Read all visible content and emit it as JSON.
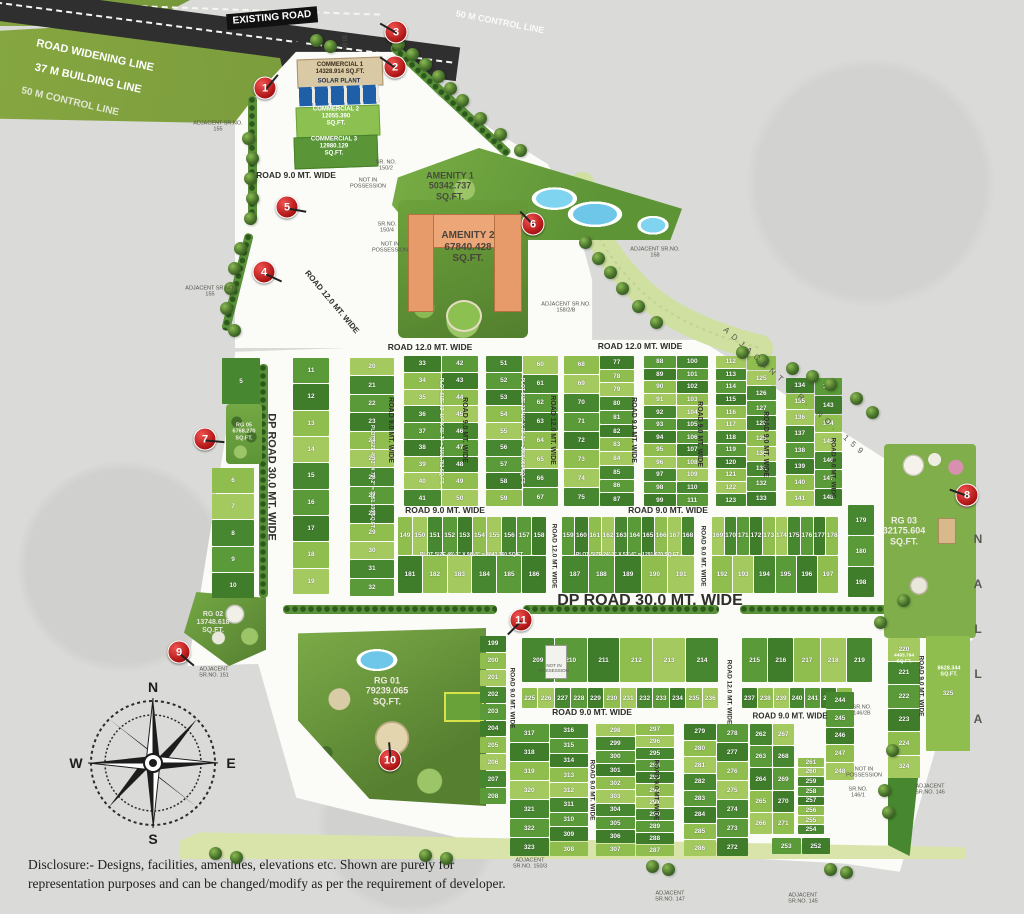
{
  "top": {
    "existing_road": "EXISTING ROAD",
    "widening": "ROAD WIDENING LINE",
    "building": "37 M BUILDING LINE",
    "control": "50 M CONTROL LINE",
    "control_right": "50 M CONTROL LINE",
    "dims": [
      "30.00",
      "37.00",
      "50.00"
    ]
  },
  "compass": {
    "north": "N",
    "east": "E",
    "south": "S",
    "west": "W"
  },
  "nalla": "NALLA",
  "disclosure": "Disclosure:- Designs, facilities, amenities, elevations etc. Shown are purely for representation purposes and can be changed/modify as per the requirement of developer.",
  "area_labels": [
    {
      "name": "commercial-1-label",
      "lines": [
        "COMMERCIAL 1",
        "14328.914 SQ.FT."
      ],
      "x": 340,
      "y": 69,
      "size": 6,
      "color": "#3a2d1c"
    },
    {
      "name": "solar-plant-label",
      "lines": [
        "SOLAR PLANT"
      ],
      "x": 339,
      "y": 82,
      "size": 6,
      "color": "#1d2b4d"
    },
    {
      "name": "commercial-2-label",
      "lines": [
        "COMMERCIAL 2",
        "12055.390",
        "SQ.FT."
      ],
      "x": 336,
      "y": 117,
      "size": 6,
      "color": "#ffffff"
    },
    {
      "name": "commercial-3-label",
      "lines": [
        "COMMERCIAL 3",
        "12980.129",
        "SQ.FT."
      ],
      "x": 334,
      "y": 147,
      "size": 6,
      "color": "#ffffff"
    },
    {
      "name": "amenity-1-label",
      "lines": [
        "AMENITY 1",
        "50342.737",
        "SQ.FT."
      ],
      "x": 450,
      "y": 186,
      "size": 9,
      "color": "#474b3e"
    },
    {
      "name": "amenity-2-label",
      "lines": [
        "AMENITY 2",
        "67840.428",
        "SQ.FT."
      ],
      "x": 468,
      "y": 247,
      "size": 10,
      "color": "#4a443c"
    },
    {
      "name": "rg-01-label",
      "lines": [
        "RG 01",
        "79239.065",
        "SQ.FT."
      ],
      "x": 387,
      "y": 691,
      "size": 9,
      "color": "#eceadf"
    },
    {
      "name": "rg-02-label",
      "lines": [
        "RG 02",
        "13748.618",
        "SQ.FT."
      ],
      "x": 213,
      "y": 623,
      "size": 7,
      "color": "#e4e6da"
    },
    {
      "name": "rg-03-label",
      "lines": [
        "RG 03",
        "32175.604",
        "SQ.FT."
      ],
      "x": 904,
      "y": 531,
      "size": 9,
      "color": "#efeee4"
    },
    {
      "name": "rg-05-label",
      "lines": [
        "RG 05",
        "6768.270",
        "SQ.FT."
      ],
      "x": 244,
      "y": 432,
      "size": 5.5,
      "color": "#f2f2ea"
    },
    {
      "name": "plot-325-area-label",
      "lines": [
        "8628.344",
        "SQ.FT."
      ],
      "x": 949,
      "y": 672,
      "size": 5.5,
      "color": "#ffffff"
    },
    {
      "name": "plot-220-area-label",
      "lines": [
        "4493.794",
        "SQ.FT."
      ],
      "x": 904,
      "y": 659,
      "size": 4.8,
      "color": "#ffffff"
    }
  ],
  "road_labels": [
    {
      "t": "ROAD 9.0 MT. WIDE",
      "x": 296,
      "y": 176,
      "rot": 0,
      "size": 8.5
    },
    {
      "t": "ROAD 12.0 MT. WIDE",
      "x": 332,
      "y": 302,
      "rot": 50,
      "size": 8
    },
    {
      "t": "ROAD 12.0 MT. WIDE",
      "x": 430,
      "y": 348,
      "rot": 0,
      "size": 8.5
    },
    {
      "t": "ROAD 12.0 MT. WIDE",
      "x": 640,
      "y": 347,
      "rot": 0,
      "size": 8.5
    },
    {
      "t": "ROAD 9.0 MT. WIDE",
      "x": 390,
      "y": 430,
      "rot": 90,
      "size": 7
    },
    {
      "t": "ROAD 9.0 MT. WIDE",
      "x": 464,
      "y": 430,
      "rot": 90,
      "size": 7
    },
    {
      "t": "ROAD 12.0 MT. WIDE",
      "x": 552,
      "y": 430,
      "rot": 90,
      "size": 7
    },
    {
      "t": "ROAD 9.0 MT. WIDE",
      "x": 633,
      "y": 430,
      "rot": 90,
      "size": 7
    },
    {
      "t": "ROAD 9.0 MT. WIDE",
      "x": 699,
      "y": 434,
      "rot": 90,
      "size": 7
    },
    {
      "t": "ROAD 9.0 MT. WIDE",
      "x": 765,
      "y": 444,
      "rot": 90,
      "size": 7
    },
    {
      "t": "ROAD 9.0 MT. WIDE",
      "x": 833,
      "y": 468,
      "rot": 90,
      "size": 6.5
    },
    {
      "t": "DP ROAD 30.0 MT. WIDE",
      "x": 271,
      "y": 477,
      "rot": 90,
      "size": 11
    },
    {
      "t": "ROAD 9.0 MT. WIDE",
      "x": 445,
      "y": 511,
      "rot": 0,
      "size": 8.5
    },
    {
      "t": "ROAD 9.0 MT. WIDE",
      "x": 668,
      "y": 511,
      "rot": 0,
      "size": 8.5
    },
    {
      "t": "ROAD 12.0 MT. WIDE",
      "x": 554,
      "y": 556,
      "rot": 90,
      "size": 6.5
    },
    {
      "t": "ROAD 9.0 MT. WIDE",
      "x": 703,
      "y": 556,
      "rot": 90,
      "size": 6.5
    },
    {
      "t": "DP ROAD 30.0 MT. WIDE",
      "x": 650,
      "y": 601,
      "rot": 0,
      "size": 16
    },
    {
      "t": "ROAD 9.0 MT. WIDE",
      "x": 592,
      "y": 713,
      "rot": 0,
      "size": 8.5
    },
    {
      "t": "ROAD 9.0 MT. WIDE",
      "x": 790,
      "y": 716,
      "rot": 0,
      "size": 8
    },
    {
      "t": "ROAD 9.0 MT. WIDE",
      "x": 512,
      "y": 698,
      "rot": 90,
      "size": 6.5
    },
    {
      "t": "ROAD 9.0 MT. WIDE",
      "x": 592,
      "y": 790,
      "rot": 90,
      "size": 6.5
    },
    {
      "t": "ROAD 9.0 MT. WIDE",
      "x": 656,
      "y": 790,
      "rot": 90,
      "size": 6.5
    },
    {
      "t": "ROAD 12.0 MT. WIDE",
      "x": 729,
      "y": 692,
      "rot": 90,
      "size": 6.5
    },
    {
      "t": "ROAD 9.0 MT. WIDE",
      "x": 921,
      "y": 686,
      "rot": 90,
      "size": 6.5
    }
  ],
  "site_notes": [
    {
      "name": "adjacent-155-upper",
      "lines": [
        "ADJACENT SR.NO.",
        "155"
      ],
      "x": 218,
      "y": 127
    },
    {
      "name": "adjacent-155-lower",
      "lines": [
        "ADJACENT SR.NO.",
        "155"
      ],
      "x": 210,
      "y": 292
    },
    {
      "name": "adjacent-158",
      "lines": [
        "ADJACENT SR.NO.",
        "158"
      ],
      "x": 655,
      "y": 253
    },
    {
      "name": "adjacent-158-2-b",
      "lines": [
        "ADJACENT SR.NO.",
        "158/2/B"
      ],
      "x": 566,
      "y": 308
    },
    {
      "name": "adjacent-159",
      "lines": [
        "ADJACENT SR. NO. 159"
      ],
      "x": 795,
      "y": 392,
      "rot": 42,
      "ls": 5,
      "size": 8
    },
    {
      "name": "adjacent-151",
      "lines": [
        "ADJACENT",
        "SR.NO. 151"
      ],
      "x": 214,
      "y": 673
    },
    {
      "name": "adjacent-150-3",
      "lines": [
        "ADJACENT",
        "SR.NO. 150/3"
      ],
      "x": 530,
      "y": 864
    },
    {
      "name": "adjacent-147",
      "lines": [
        "ADJACENT",
        "SR.NO. 147"
      ],
      "x": 670,
      "y": 897
    },
    {
      "name": "adjacent-145",
      "lines": [
        "ADJACENT",
        "SR.NO. 145"
      ],
      "x": 803,
      "y": 899
    },
    {
      "name": "adjacent-146",
      "lines": [
        "ADJACENT",
        "SR.NO. 146"
      ],
      "x": 930,
      "y": 790
    },
    {
      "name": "sr-no-150-2",
      "lines": [
        "SR. NO.",
        "150/2"
      ],
      "x": 386,
      "y": 166
    },
    {
      "name": "sr-no-150-4",
      "lines": [
        "SR.NO.",
        "150/4"
      ],
      "x": 387,
      "y": 228
    },
    {
      "name": "sr-no-146-2b",
      "lines": [
        "SR.NO.",
        "146/2B"
      ],
      "x": 862,
      "y": 711
    },
    {
      "name": "sr-no-146-1",
      "lines": [
        "SR.NO.",
        "146/1"
      ],
      "x": 858,
      "y": 793
    },
    {
      "name": "not-in-possession-1",
      "lines": [
        "NOT IN",
        "POSSESSION"
      ],
      "x": 368,
      "y": 184
    },
    {
      "name": "not-in-possession-2",
      "lines": [
        "NOT IN",
        "POSSESSION"
      ],
      "x": 390,
      "y": 248
    },
    {
      "name": "not-in-possession-3",
      "lines": [
        "NOT IN",
        "POSSESSION"
      ],
      "x": 554,
      "y": 668,
      "size": 4.5
    },
    {
      "name": "not-in-possession-4",
      "lines": [
        "NOT IN",
        "POSSESSION"
      ],
      "x": 864,
      "y": 773
    }
  ],
  "markers": [
    {
      "n": "1",
      "x": 265,
      "y": 88,
      "ang": -50
    },
    {
      "n": "2",
      "x": 395,
      "y": 67,
      "ang": 215
    },
    {
      "n": "3",
      "x": 396,
      "y": 32,
      "ang": 210
    },
    {
      "n": "4",
      "x": 264,
      "y": 272,
      "ang": 25
    },
    {
      "n": "5",
      "x": 287,
      "y": 207,
      "ang": 10
    },
    {
      "n": "6",
      "x": 533,
      "y": 224,
      "ang": 225
    },
    {
      "n": "7",
      "x": 205,
      "y": 439,
      "ang": 5
    },
    {
      "n": "8",
      "x": 967,
      "y": 495,
      "ang": 200
    },
    {
      "n": "9",
      "x": 179,
      "y": 652,
      "ang": 40
    },
    {
      "n": "10",
      "x": 390,
      "y": 760,
      "ang": -95
    },
    {
      "n": "11",
      "x": 521,
      "y": 620,
      "ang": 135
    }
  ],
  "plot_blocks": [
    {
      "name": "plots-5",
      "x": 222,
      "y": 358,
      "w": 38,
      "h": 46,
      "cols": [
        [
          5
        ]
      ]
    },
    {
      "name": "plots-6-10",
      "x": 212,
      "y": 468,
      "w": 42,
      "h": 130,
      "cols": [
        [
          6,
          7,
          8,
          9,
          10
        ]
      ]
    },
    {
      "name": "plots-11-19",
      "x": 293,
      "y": 358,
      "w": 36,
      "h": 236,
      "cols": [
        [
          11,
          12,
          13,
          14,
          15,
          16,
          17,
          18,
          19
        ]
      ]
    },
    {
      "name": "plots-20-32",
      "x": 350,
      "y": 358,
      "w": 44,
      "h": 238,
      "cols": [
        [
          20,
          21,
          22,
          23,
          24,
          25,
          26,
          27,
          28,
          29,
          30,
          31,
          32
        ]
      ],
      "note": {
        "t": "PLOT SIZE 49'-3\" X 72'-2\" = 3551.930 SQ.FT.",
        "rot": 90
      }
    },
    {
      "name": "plots-33-50",
      "x": 404,
      "y": 356,
      "w": 74,
      "h": 150,
      "cols": [
        [
          33,
          34,
          35,
          36,
          37,
          38,
          39,
          40,
          41
        ],
        [
          42,
          43,
          44,
          45,
          46,
          47,
          48,
          49,
          50
        ]
      ],
      "note": {
        "t": "PLOT SIZE 32'-10\" X 65'-7\" = 2152.782 SQ.FT.",
        "rot": 90
      }
    },
    {
      "name": "plots-51-67",
      "x": 486,
      "y": 356,
      "w": 72,
      "h": 150,
      "cols": [
        [
          51,
          52,
          53,
          54,
          55,
          56,
          57,
          58,
          59
        ],
        [
          60,
          61,
          62,
          63,
          64,
          65,
          66,
          67
        ]
      ],
      "note": {
        "t": "PLOT SIZE 32'-10\" X 72'-2\" = 2368.060 SQ.FT.",
        "rot": 90
      }
    },
    {
      "name": "plots-68-87",
      "x": 564,
      "y": 356,
      "w": 70,
      "h": 150,
      "cols": [
        [
          68,
          69,
          70,
          71,
          72,
          73,
          74,
          75
        ],
        [
          77,
          78,
          79,
          80,
          81,
          82,
          83,
          84,
          85,
          86,
          87
        ]
      ]
    },
    {
      "name": "plots-88-111",
      "x": 644,
      "y": 356,
      "w": 64,
      "h": 150,
      "cols": [
        [
          88,
          89,
          90,
          91,
          92,
          93,
          94,
          95,
          96,
          97,
          98,
          99
        ],
        [
          100,
          101,
          102,
          103,
          104,
          105,
          106,
          107,
          108,
          109,
          110,
          111
        ]
      ]
    },
    {
      "name": "plots-112-133",
      "x": 716,
      "y": 356,
      "w": 60,
      "h": 150,
      "cols": [
        [
          112,
          113,
          114,
          115,
          116,
          117,
          118,
          119,
          120,
          121,
          122,
          123
        ],
        [
          124,
          125,
          126,
          127,
          128,
          129,
          130,
          131,
          132,
          133
        ]
      ]
    },
    {
      "name": "plots-134-148",
      "x": 786,
      "y": 378,
      "w": 56,
      "h": 128,
      "cols": [
        [
          134,
          135,
          136,
          137,
          138,
          139,
          140,
          141
        ],
        [
          142,
          143,
          144,
          145,
          146,
          147,
          148
        ]
      ]
    },
    {
      "name": "plots-179-198",
      "x": 848,
      "y": 505,
      "w": 26,
      "h": 92,
      "cols": [
        [
          179,
          180,
          198
        ]
      ]
    },
    {
      "name": "plots-149-186",
      "x": 398,
      "y": 517,
      "w": 148,
      "h": 76,
      "rows": [
        [
          149,
          150,
          151,
          152,
          153,
          154,
          155,
          156,
          157,
          158
        ],
        [
          181,
          182,
          183,
          184,
          185,
          186
        ]
      ],
      "note": {
        "t": "PLOT SIZE 49'-3\" X 98'-5\" = 4843.760 SQ.FT.",
        "rot": 0
      }
    },
    {
      "name": "plots-159-191",
      "x": 562,
      "y": 517,
      "w": 132,
      "h": 76,
      "rows": [
        [
          159,
          160,
          161,
          162,
          163,
          164,
          165,
          166,
          167,
          168
        ],
        [
          187,
          188,
          189,
          190,
          191
        ]
      ],
      "note": {
        "t": "PLOT SIZE 24'-7\" X 52'-6\" = 1291.670 SQ.FT.",
        "rot": 0
      }
    },
    {
      "name": "plots-169-197",
      "x": 712,
      "y": 517,
      "w": 126,
      "h": 76,
      "rows": [
        [
          169,
          170,
          171,
          172,
          173,
          174,
          175,
          176,
          177,
          178
        ],
        [
          192,
          193,
          194,
          195,
          196,
          197
        ]
      ]
    },
    {
      "name": "plots-199-208",
      "x": 480,
      "y": 636,
      "w": 26,
      "h": 168,
      "cols": [
        [
          199,
          200,
          201,
          202,
          203,
          204,
          205,
          206,
          207,
          208
        ]
      ]
    },
    {
      "name": "plots-209-214",
      "x": 522,
      "y": 638,
      "w": 196,
      "h": 44,
      "rows": [
        [
          209,
          210,
          211,
          212,
          213,
          214
        ]
      ]
    },
    {
      "name": "plots-225-236",
      "x": 522,
      "y": 688,
      "w": 196,
      "h": 20,
      "rows": [
        [
          225,
          226,
          227,
          228,
          229,
          230,
          231,
          232,
          233,
          234,
          235,
          236
        ]
      ]
    },
    {
      "name": "plots-215-219",
      "x": 742,
      "y": 638,
      "w": 130,
      "h": 44,
      "rows": [
        [
          215,
          216,
          217,
          218,
          219
        ]
      ]
    },
    {
      "name": "plots-220-324",
      "x": 888,
      "y": 638,
      "w": 32,
      "h": 140,
      "cols": [
        [
          220,
          221,
          222,
          223,
          224,
          324
        ]
      ]
    },
    {
      "name": "plots-237-243",
      "x": 742,
      "y": 688,
      "w": 110,
      "h": 20,
      "rows": [
        [
          237,
          238,
          239,
          240,
          241,
          242,
          243
        ]
      ]
    },
    {
      "name": "plots-244-248",
      "x": 826,
      "y": 692,
      "w": 28,
      "h": 88,
      "cols": [
        [
          244,
          245,
          246,
          247,
          248
        ]
      ]
    },
    {
      "name": "plot-325",
      "x": 926,
      "y": 636,
      "w": 44,
      "h": 115,
      "cols": [
        [
          325
        ]
      ]
    },
    {
      "name": "plots-308-323",
      "x": 510,
      "y": 724,
      "w": 78,
      "h": 132,
      "cols": [
        [
          317,
          318,
          319,
          320,
          321,
          322,
          323
        ],
        [
          316,
          315,
          314,
          313,
          312,
          311,
          310,
          309,
          308
        ]
      ]
    },
    {
      "name": "plots-287-307",
      "x": 596,
      "y": 724,
      "w": 78,
      "h": 132,
      "cols": [
        [
          298,
          299,
          300,
          301,
          302,
          303,
          304,
          305,
          306,
          307
        ],
        [
          297,
          296,
          295,
          294,
          293,
          292,
          291,
          290,
          289,
          288,
          287
        ]
      ]
    },
    {
      "name": "plots-272-286",
      "x": 684,
      "y": 724,
      "w": 64,
      "h": 132,
      "cols": [
        [
          279,
          280,
          281,
          282,
          283,
          284,
          285,
          286
        ],
        [
          278,
          277,
          276,
          275,
          274,
          273,
          272
        ]
      ]
    },
    {
      "name": "plots-262-271",
      "x": 750,
      "y": 724,
      "w": 44,
      "h": 110,
      "cols": [
        [
          262,
          263,
          264,
          265,
          266
        ],
        [
          267,
          268,
          269,
          270,
          271
        ]
      ]
    },
    {
      "name": "plots-254-261",
      "x": 798,
      "y": 758,
      "w": 26,
      "h": 76,
      "cols": [
        [
          261,
          260,
          259,
          258,
          257,
          256,
          255,
          254
        ]
      ]
    },
    {
      "name": "plots-252-253",
      "x": 772,
      "y": 838,
      "w": 58,
      "h": 16,
      "rows": [
        [
          253,
          252
        ]
      ]
    }
  ]
}
